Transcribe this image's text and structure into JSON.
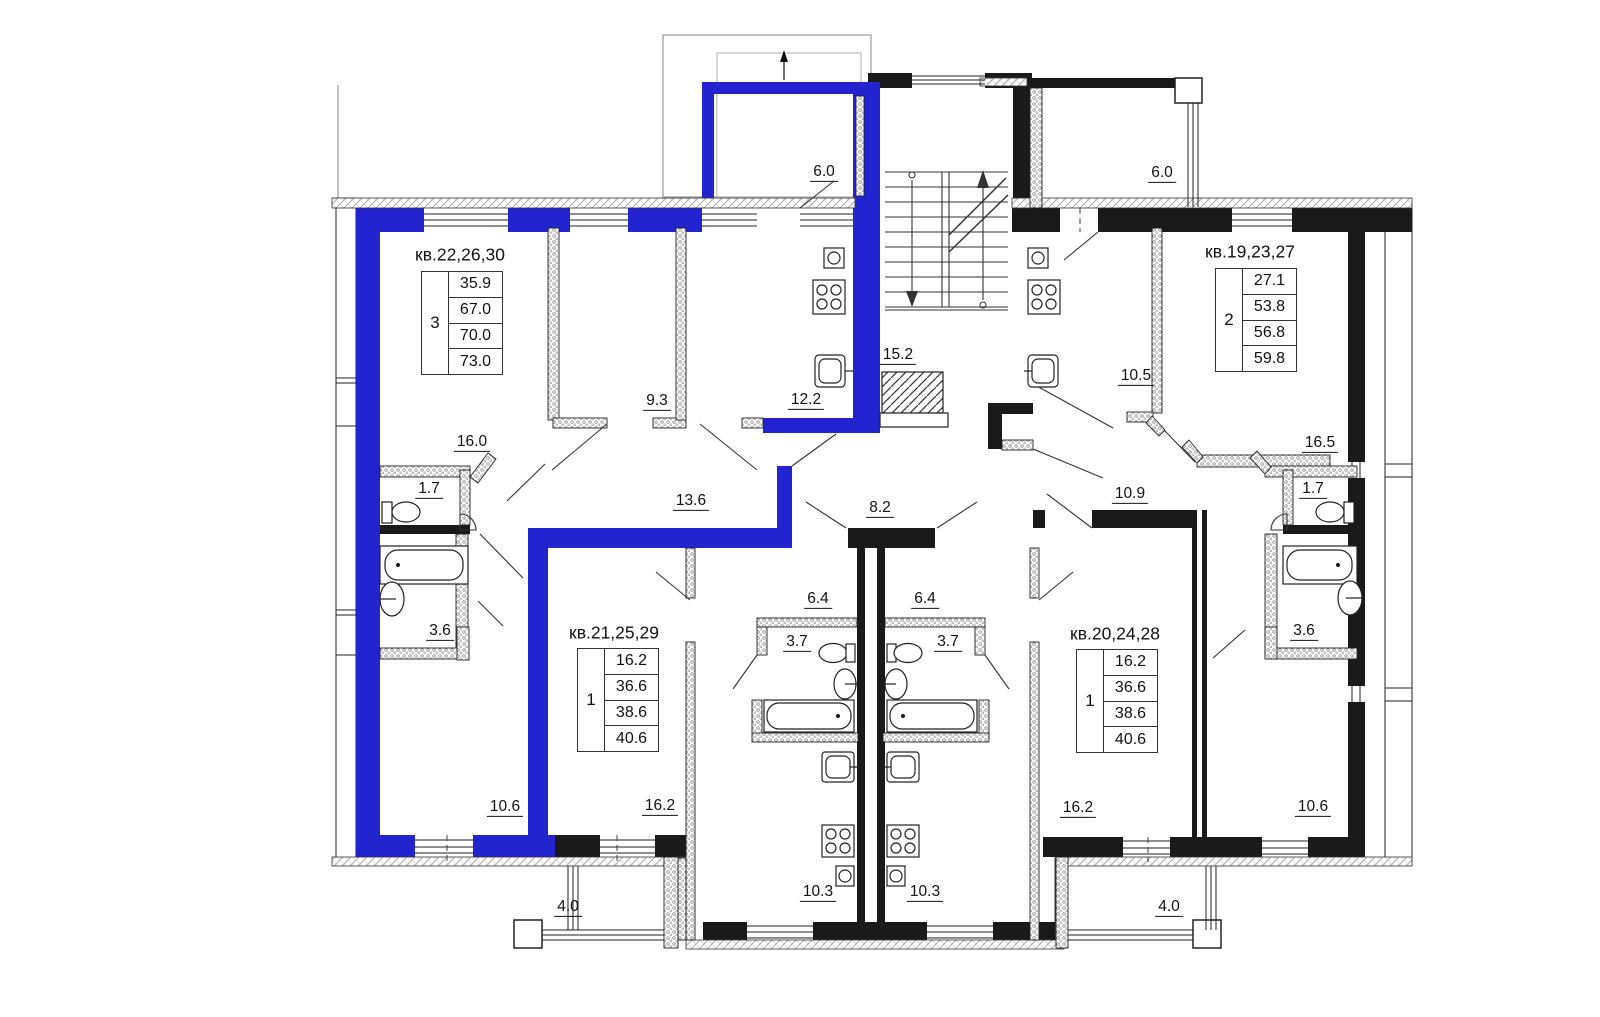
{
  "colors": {
    "highlight": "#2323d0",
    "wall": "#1a1a1a"
  },
  "plan": {
    "apartments": [
      {
        "header": "кв.22,26,30",
        "rooms": "3",
        "areas": [
          "35.9",
          "67.0",
          "70.0",
          "73.0"
        ]
      },
      {
        "header": "кв.19,23,27",
        "rooms": "2",
        "areas": [
          "27.1",
          "53.8",
          "56.8",
          "59.8"
        ]
      },
      {
        "header": "кв.21,25,29",
        "rooms": "1",
        "areas": [
          "16.2",
          "36.6",
          "38.6",
          "40.6"
        ]
      },
      {
        "header": "кв.20,24,28",
        "rooms": "1",
        "areas": [
          "16.2",
          "36.6",
          "38.6",
          "40.6"
        ]
      }
    ],
    "room_labels": [
      {
        "id": "balcony-top-left",
        "text": "6.0"
      },
      {
        "id": "balcony-top-right",
        "text": "6.0"
      },
      {
        "id": "stair-landing",
        "text": "15.2"
      },
      {
        "id": "apt22-room",
        "text": "9.3"
      },
      {
        "id": "apt22-kitchen",
        "text": "12.2"
      },
      {
        "id": "apt22-living",
        "text": "16.0"
      },
      {
        "id": "apt22-wc",
        "text": "1.7"
      },
      {
        "id": "apt22-hall",
        "text": "13.6"
      },
      {
        "id": "corridor",
        "text": "8.2"
      },
      {
        "id": "apt19-hall",
        "text": "10.9"
      },
      {
        "id": "apt19-kitchen",
        "text": "10.5"
      },
      {
        "id": "apt19-living",
        "text": "16.5"
      },
      {
        "id": "apt19-wc",
        "text": "1.7"
      },
      {
        "id": "apt22-bath",
        "text": "3.6"
      },
      {
        "id": "apt19-bath",
        "text": "3.6"
      },
      {
        "id": "apt21-hall",
        "text": "6.4"
      },
      {
        "id": "apt20-hall",
        "text": "6.4"
      },
      {
        "id": "apt21-bath",
        "text": "3.7"
      },
      {
        "id": "apt20-bath",
        "text": "3.7"
      },
      {
        "id": "apt22-bedroom",
        "text": "10.6"
      },
      {
        "id": "apt19-bedroom",
        "text": "10.6"
      },
      {
        "id": "apt21-living",
        "text": "16.2"
      },
      {
        "id": "apt20-living",
        "text": "16.2"
      },
      {
        "id": "apt21-kitchen",
        "text": "10.3"
      },
      {
        "id": "apt20-kitchen",
        "text": "10.3"
      },
      {
        "id": "balcony-bottom-left",
        "text": "4.0"
      },
      {
        "id": "balcony-bottom-right",
        "text": "4.0"
      }
    ]
  }
}
